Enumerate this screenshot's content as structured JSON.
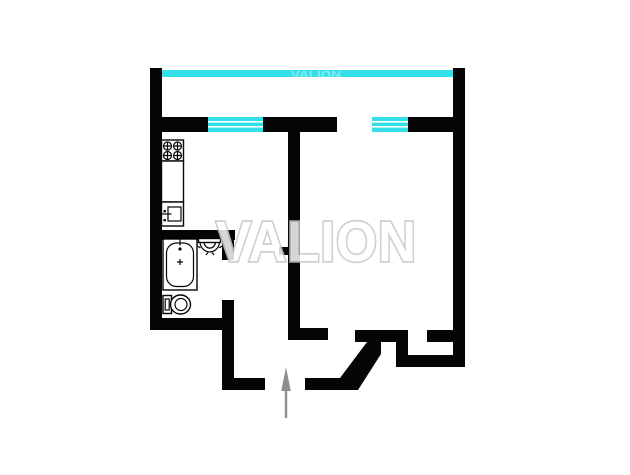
{
  "watermark": {
    "text": "VALION"
  },
  "plan": {
    "type": "apartment-floor-plan",
    "colors": {
      "background": "#ffffff",
      "wall": "#050505",
      "window": "#35dfe9",
      "arrow": "#8f8f8f",
      "watermark-fill": "#ffffff",
      "watermark-outline": "#c6c6c6"
    },
    "features": {
      "balcony_glazing": "full-width glazed balcony band at top",
      "windows": [
        "kitchen-window",
        "room-window"
      ],
      "openings": [
        "balcony-door-gap",
        "kitchen-doorway",
        "bathroom-doorway",
        "room-doorway",
        "closet-doorway",
        "entrance-doorway"
      ],
      "fixtures": [
        "stove-icon",
        "kitchen-counter",
        "kitchen-sink-icon",
        "bathtub-icon",
        "washbasin-icon",
        "toilet-icon"
      ],
      "entrance_marker": "entrance-arrow-icon"
    }
  }
}
